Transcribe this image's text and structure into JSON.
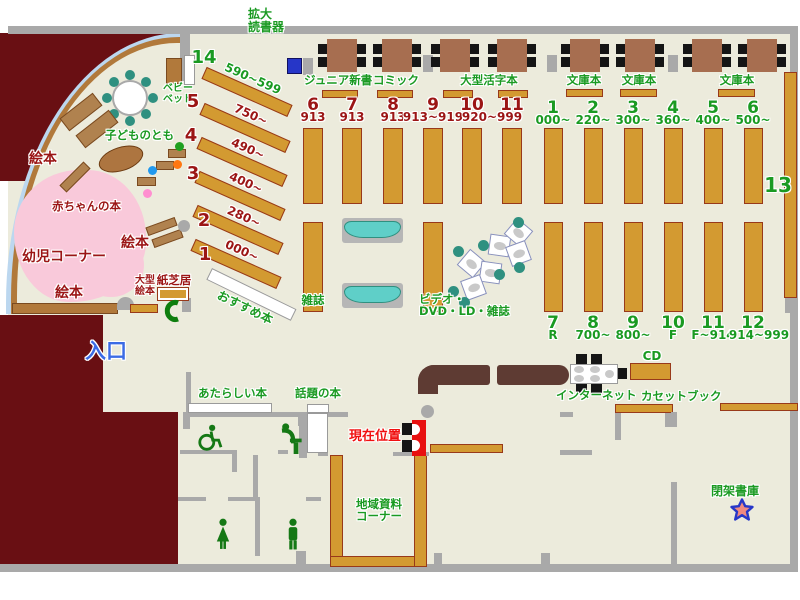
{
  "children_area": {
    "baby_bed_1": "ベビー",
    "baby_bed_2": "ベッド",
    "kodomo_no_tomo": "子どものとも",
    "picture_books_top": "絵本",
    "picture_books_mid": "絵本",
    "picture_books_bottom": "絵本",
    "baby_books": "赤ちゃんの本",
    "infant_corner": "幼児コーナー",
    "large_picture_books_1": "大型",
    "large_picture_books_2": "絵本",
    "kamishibai": "紙芝居"
  },
  "entrance": "入口",
  "magnifier_1": "拡大",
  "magnifier_2": "読書器",
  "recommended_books": "おすすめ本",
  "diagonal": {
    "numbers": [
      "14",
      "5",
      "4",
      "3",
      "2",
      "1"
    ],
    "ranges": [
      "590~599",
      "750~",
      "490~",
      "400~",
      "280~",
      "000~"
    ]
  },
  "sections": {
    "junior_shinsho": "ジュニア新書",
    "comic": "コミック",
    "large_print": "大型活字本",
    "bunko_a": "文庫本",
    "bunko_b": "文庫本",
    "bunko_c": "文庫本"
  },
  "mid": {
    "numbers": [
      "6",
      "7",
      "8",
      "9",
      "10",
      "11"
    ],
    "ranges": [
      "913",
      "913",
      "913",
      "913~919",
      "920~999"
    ]
  },
  "right_top": {
    "numbers": [
      "1",
      "2",
      "3",
      "4",
      "5",
      "6"
    ],
    "ranges": [
      "000~",
      "220~",
      "300~",
      "360~",
      "400~",
      "500~"
    ]
  },
  "right_bottom": {
    "numbers": [
      "7",
      "8",
      "9",
      "10",
      "11",
      "12"
    ],
    "ranges": [
      "R",
      "700~",
      "800~",
      "F",
      "F~914",
      "914~999"
    ]
  },
  "shelf_13": "13",
  "media": {
    "magazines": "雑誌",
    "av_1": "ビデオ・",
    "av_2": "DVD・LD・雑誌",
    "internet": "インターネット",
    "cd": "CD",
    "cassette_books": "カセットブック"
  },
  "south": {
    "new_books": "あたらしい本",
    "topic_books": "話題の本",
    "local_corner_1": "地域資料",
    "local_corner_2": "コーナー",
    "closed_stacks": "閉架書庫"
  },
  "current_position": "現在位置",
  "colors": {
    "floor": "#ECEBDC",
    "wall": "#A9A9A9",
    "maroon": "#690F13",
    "shelf": "#D39A31",
    "green_text": "#1A9A22",
    "dark_red_text": "#9B1515",
    "teal": "#2F9080",
    "pink_area": "#F9C9DA",
    "sofa_teal": "#5FCFC8",
    "entrance_blue": "#3B6BE5",
    "marker_red": "#E81010"
  }
}
